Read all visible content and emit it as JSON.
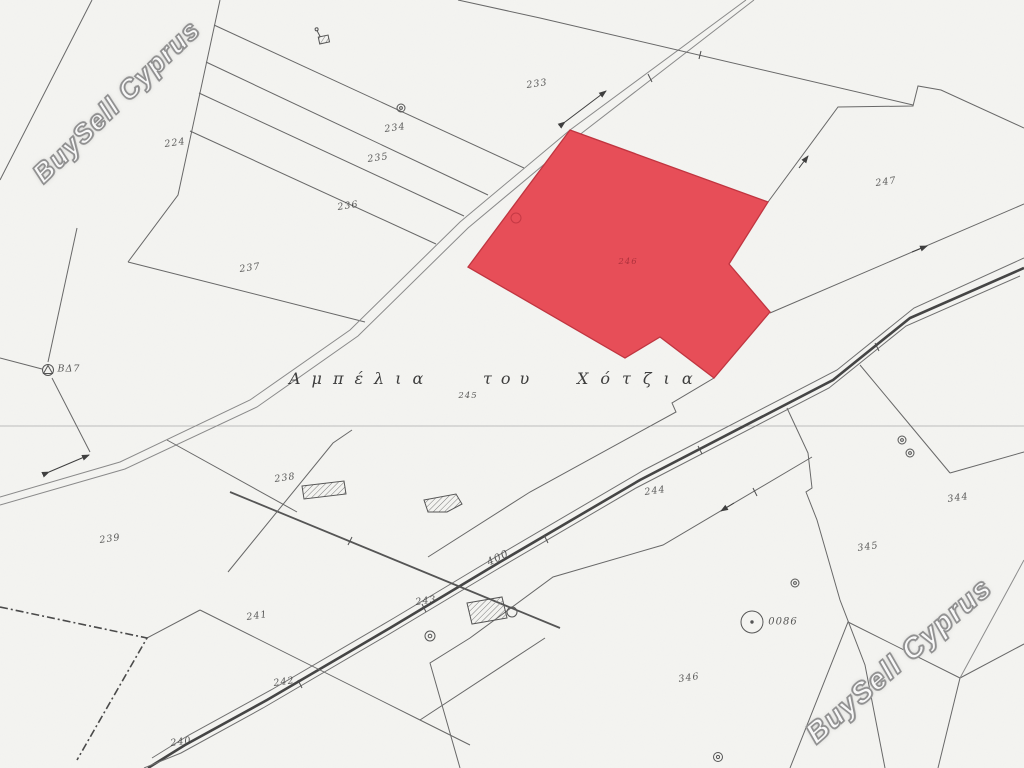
{
  "map": {
    "watermark": {
      "text": "BuySell Cyprus"
    },
    "toponym": {
      "words": [
        {
          "w": "Αμπέλια",
          "x": 289,
          "ls": 11
        },
        {
          "w": "του",
          "x": 483,
          "ls": 9
        },
        {
          "w": "Χότζια",
          "x": 577,
          "ls": 12
        }
      ]
    },
    "highlight": {
      "parcel": "246",
      "fill": "#e74e58",
      "stroke": "#c03540"
    },
    "labels": [
      {
        "t": "224",
        "x": 175,
        "y": 143,
        "r": -8
      },
      {
        "t": "233",
        "x": 537,
        "y": 84,
        "r": -8
      },
      {
        "t": "234",
        "x": 395,
        "y": 128,
        "r": -8
      },
      {
        "t": "235",
        "x": 378,
        "y": 158,
        "r": -8
      },
      {
        "t": "236",
        "x": 348,
        "y": 206,
        "r": -8
      },
      {
        "t": "237",
        "x": 250,
        "y": 268,
        "r": -8
      },
      {
        "t": "238",
        "x": 285,
        "y": 478,
        "r": -8
      },
      {
        "t": "239",
        "x": 110,
        "y": 539,
        "r": -8
      },
      {
        "t": "240",
        "x": 181,
        "y": 742,
        "r": -8
      },
      {
        "t": "241",
        "x": 257,
        "y": 616,
        "r": -8
      },
      {
        "t": "242",
        "x": 284,
        "y": 682,
        "r": -8
      },
      {
        "t": "243",
        "x": 426,
        "y": 601,
        "r": -8
      },
      {
        "t": "244",
        "x": 655,
        "y": 491,
        "r": -8
      },
      {
        "t": "245",
        "x": 468,
        "y": 396,
        "r": 0,
        "s": 8.5
      },
      {
        "t": "246",
        "x": 628,
        "y": 262,
        "r": 0,
        "s": 8.5,
        "cls": "on-red"
      },
      {
        "t": "247",
        "x": 886,
        "y": 182,
        "r": -8
      },
      {
        "t": "344",
        "x": 958,
        "y": 498,
        "r": -8
      },
      {
        "t": "345",
        "x": 868,
        "y": 547,
        "r": -8
      },
      {
        "t": "346",
        "x": 689,
        "y": 678,
        "r": -8
      },
      {
        "t": "400",
        "x": 498,
        "y": 558,
        "r": -26,
        "s": 10.5
      },
      {
        "t": "0086",
        "x": 783,
        "y": 622,
        "r": 0,
        "s": 10
      },
      {
        "t": "ΒΔ7",
        "x": 69,
        "y": 369,
        "r": 0,
        "s": 9.5
      }
    ]
  }
}
